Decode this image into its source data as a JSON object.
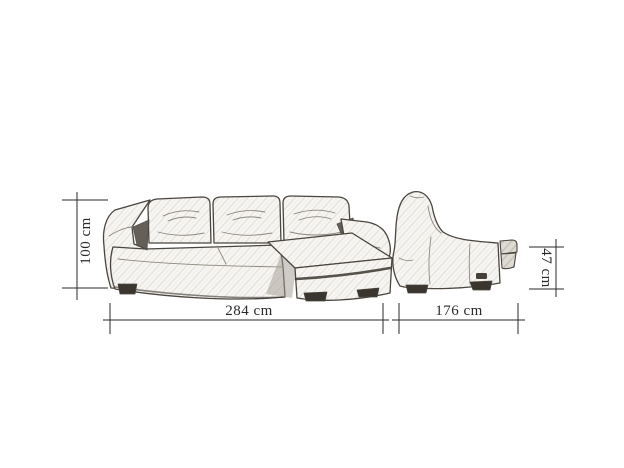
{
  "diagram": {
    "subject": "corner-sofa-with-chaise",
    "views": {
      "front": {
        "name": "front elevation"
      },
      "side": {
        "name": "side elevation"
      }
    },
    "dimensions": {
      "height": {
        "label": "100 cm"
      },
      "width": {
        "label": "284 cm"
      },
      "depth": {
        "label": "176 cm"
      },
      "seat_height": {
        "label": "47 cm"
      }
    }
  },
  "colors": {
    "ink": "#2b2a28",
    "sketch": "#4a463f",
    "sketch-light": "#8d887f",
    "accent": "#3a362f",
    "shade": "#e7e4df",
    "paper": "#ffffff"
  }
}
